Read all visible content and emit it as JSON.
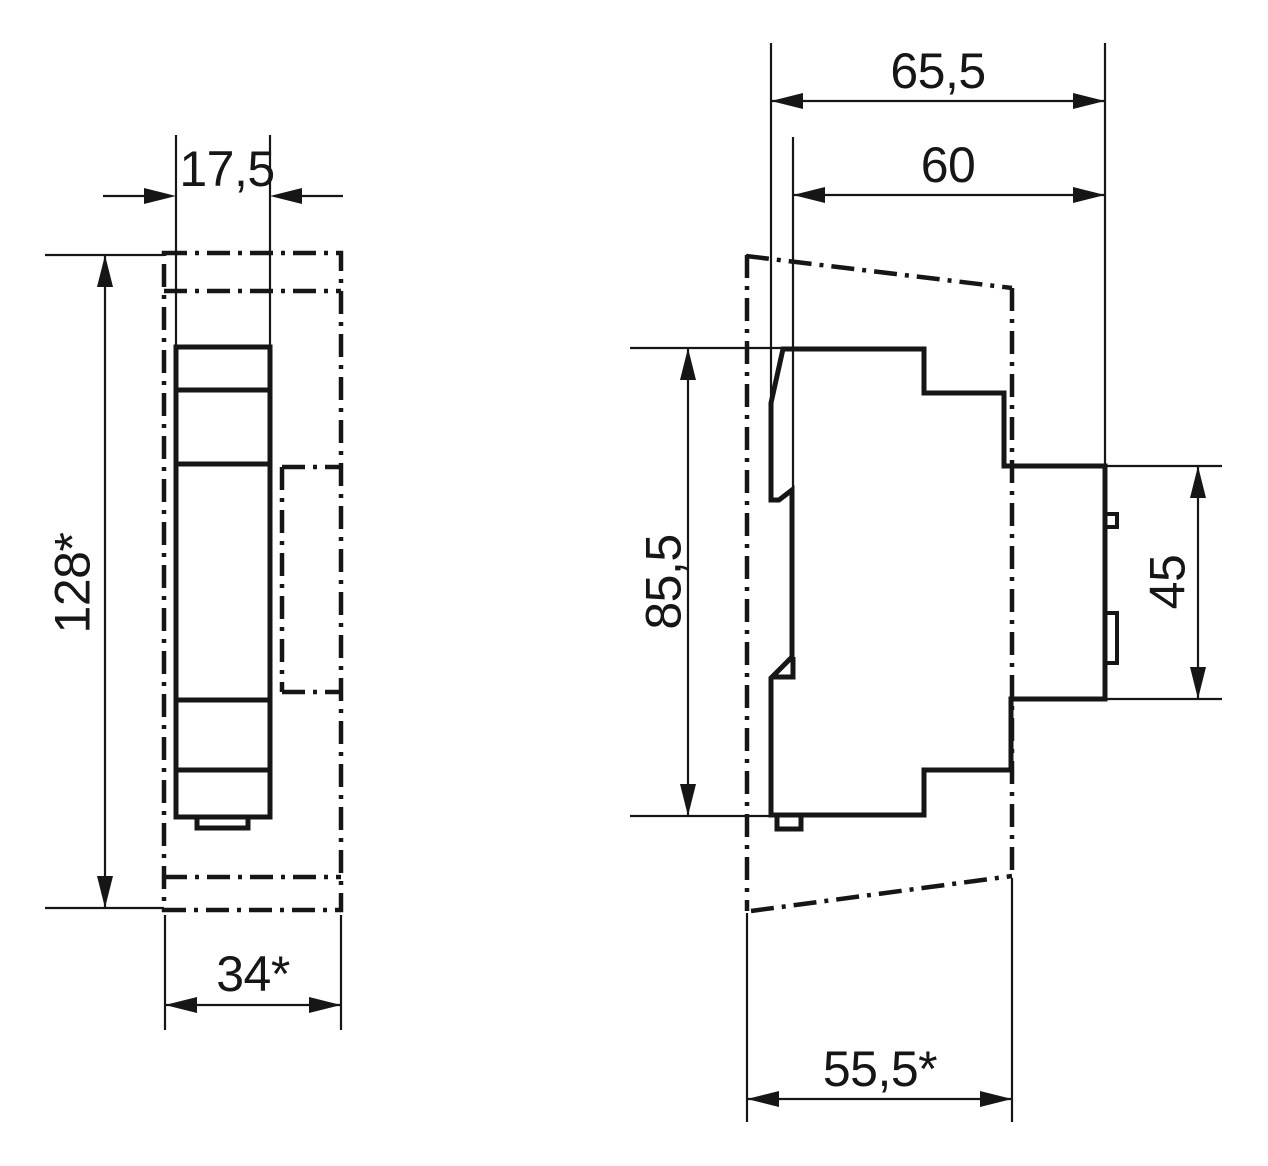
{
  "drawing": {
    "kind": "dimensional-drawing",
    "colors": {
      "line": "#161616",
      "background": "#ffffff"
    },
    "views": {
      "front": {
        "name": "front-view-din-module",
        "dimensions": {
          "module_width": "17,5",
          "overall_height": "128*",
          "cover_section_width": "34*"
        }
      },
      "side": {
        "name": "side-view-din-module",
        "dimensions": {
          "total_depth": "65,5",
          "depth_from_rail": "60",
          "body_height": "85,5",
          "front_collar_height": "45",
          "flush_mount_depth": "55,5*"
        }
      }
    }
  }
}
